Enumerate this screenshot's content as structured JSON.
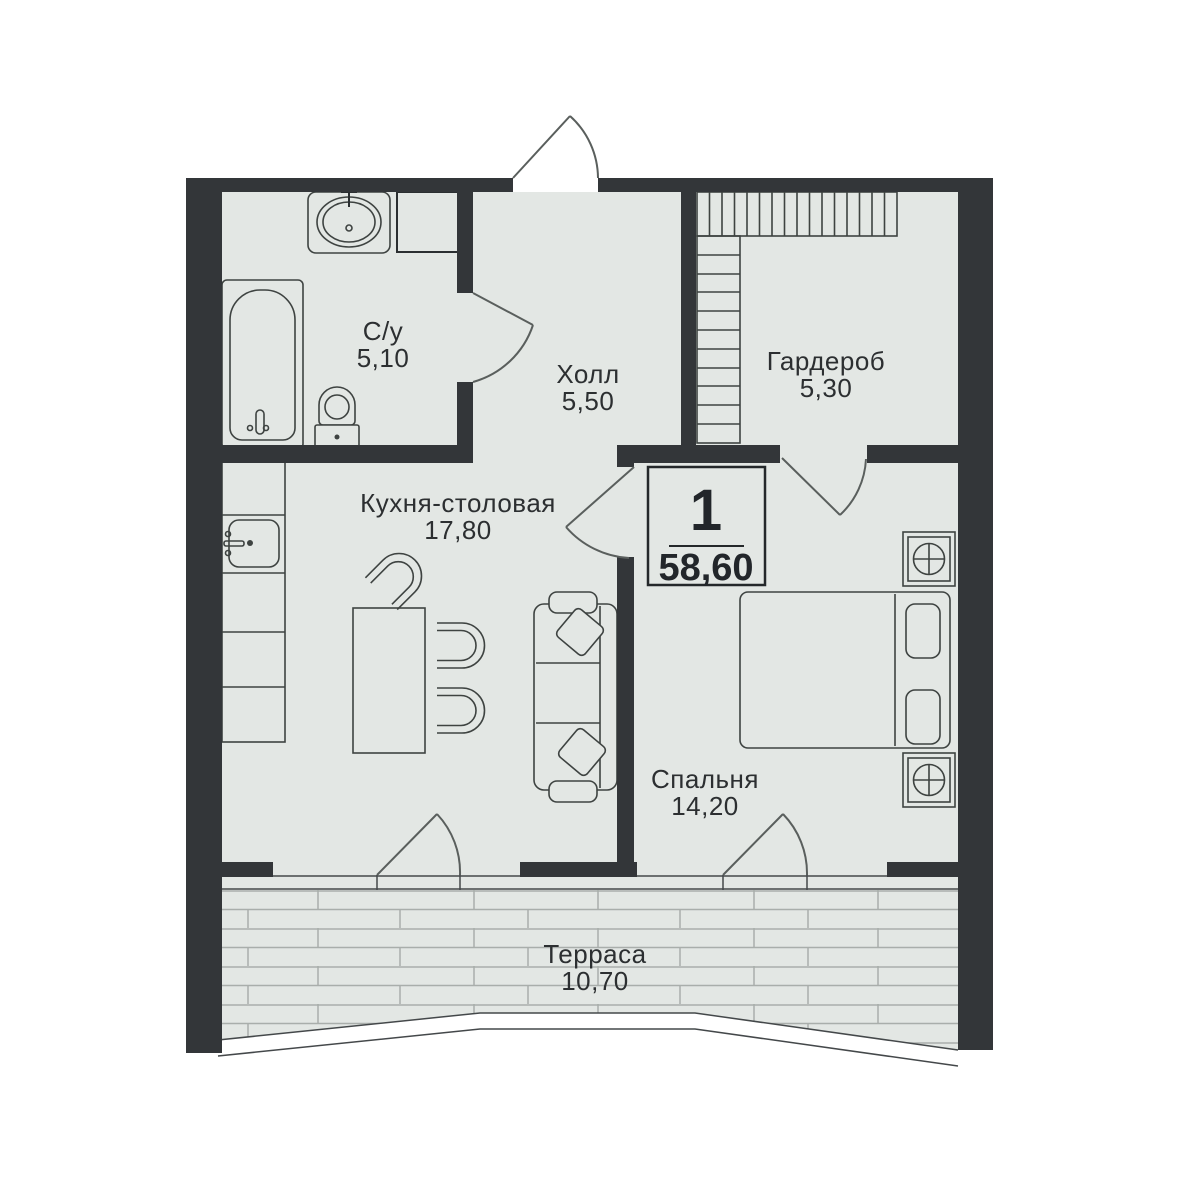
{
  "plan": {
    "badge": {
      "rooms_count": "1",
      "total_area": "58,60"
    },
    "rooms": [
      {
        "label": "С/у",
        "area": "5,10"
      },
      {
        "label": "Холл",
        "area": "5,50"
      },
      {
        "label": "Гардероб",
        "area": "5,30"
      },
      {
        "label": "Кухня-столовая",
        "area": "17,80"
      },
      {
        "label": "Спальня",
        "area": "14,20"
      },
      {
        "label": "Терраса",
        "area": "10,70"
      }
    ],
    "colors": {
      "wall": "#333639",
      "floor": "#e3e7e4",
      "furniture_line": "#3e4341",
      "door_line": "#5a5f5d",
      "deck_line": "#a9aeab",
      "text": "#2c2f31",
      "background": "#ffffff"
    }
  }
}
